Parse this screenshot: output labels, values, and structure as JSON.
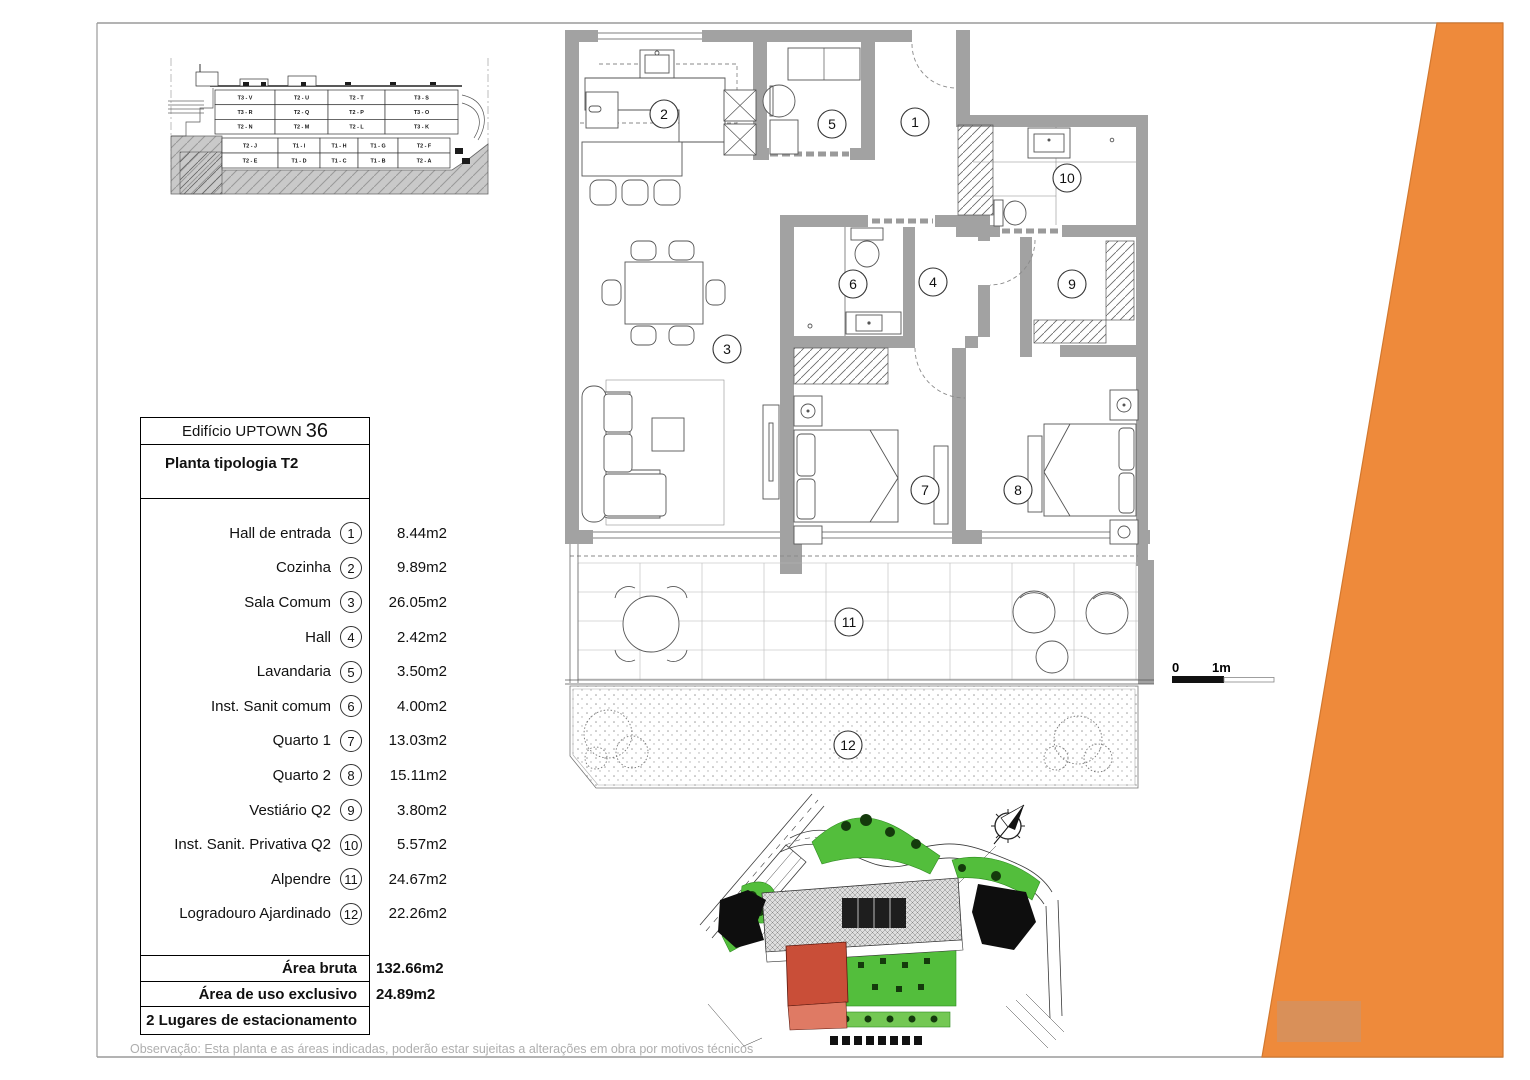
{
  "document": {
    "title_building": "Edifício UPTOWN",
    "title_number": "36",
    "subtitle": "Planta tipologia T2",
    "observation": "Observação: Esta planta e as áreas indicadas, poderão estar sujeitas a alterações em obra por motivos técnicos"
  },
  "legend": {
    "rows": [
      {
        "name": "Hall de entrada",
        "num": "1",
        "area": "8.44m2"
      },
      {
        "name": "Cozinha",
        "num": "2",
        "area": "9.89m2"
      },
      {
        "name": "Sala Comum",
        "num": "3",
        "area": "26.05m2"
      },
      {
        "name": "Hall",
        "num": "4",
        "area": "2.42m2"
      },
      {
        "name": "Lavandaria",
        "num": "5",
        "area": "3.50m2"
      },
      {
        "name": "Inst. Sanit comum",
        "num": "6",
        "area": "4.00m2"
      },
      {
        "name": "Quarto 1",
        "num": "7",
        "area": "13.03m2"
      },
      {
        "name": "Quarto 2",
        "num": "8",
        "area": "15.11m2"
      },
      {
        "name": "Vestiário Q2",
        "num": "9",
        "area": "3.80m2"
      },
      {
        "name": "Inst. Sanit. Privativa Q2",
        "num": "10",
        "area": "5.57m2"
      },
      {
        "name": "Alpendre",
        "num": "11",
        "area": "24.67m2"
      },
      {
        "name": "Logradouro Ajardinado",
        "num": "12",
        "area": "22.26m2"
      }
    ],
    "totals": [
      {
        "label": "Área bruta",
        "value": "132.66m2"
      },
      {
        "label": "Área de uso exclusivo",
        "value": "24.89m2"
      },
      {
        "label": "2 Lugares de estacionamento",
        "value": ""
      }
    ]
  },
  "section": {
    "upper_rows": [
      [
        "T3 - V",
        "T2 - U",
        "T2 - T",
        "T3 - S"
      ],
      [
        "T3 - R",
        "T2 - Q",
        "T2 - P",
        "T3 - O"
      ],
      [
        "T2 - N",
        "T2 - M",
        "T2 - L",
        "T3 - K"
      ]
    ],
    "lower_rows": [
      [
        "T2 - J",
        "T1 - I",
        "T1 - H",
        "T1 - G",
        "T2 - F"
      ],
      [
        "T2 - E",
        "T1 - D",
        "T1 - C",
        "T1 - B",
        "T2 - A"
      ]
    ],
    "highlighted_unit": "T2 - E"
  },
  "plan": {
    "room_numbers": [
      "1",
      "2",
      "3",
      "4",
      "5",
      "6",
      "7",
      "8",
      "9",
      "10",
      "11",
      "12"
    ]
  },
  "scale_bar": {
    "start": "0",
    "mid": "1m"
  },
  "colors": {
    "accent_orange": "#EE8A3B",
    "accent_orange_edge": "#D2782F",
    "watermark_orange": "#D99059",
    "highlight_red": "#EB8172",
    "site_red": "#C94E38",
    "site_red_light": "#DF7A64",
    "site_green": "#53BE3C",
    "site_green_light": "#74C854",
    "wall_gray": "#A2A2A2"
  }
}
